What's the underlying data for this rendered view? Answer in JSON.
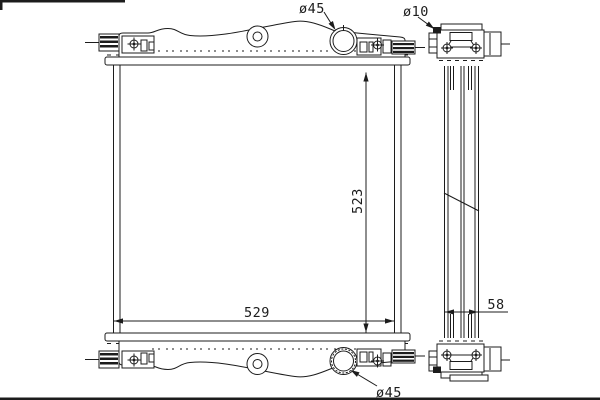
{
  "drawing": {
    "type": "technical-drawing",
    "subject": "radiator",
    "views": {
      "front": "front view",
      "side": "side view"
    }
  },
  "labels": {
    "filler_neck_diameter_top": "ø45",
    "mounting_hole_diameter": "ø10",
    "core_height": "523",
    "core_width": "529",
    "core_depth": "58",
    "outlet_diameter_bottom": "ø45"
  },
  "colors": {
    "line": "#1c1c1c",
    "background": "#ffffff"
  }
}
